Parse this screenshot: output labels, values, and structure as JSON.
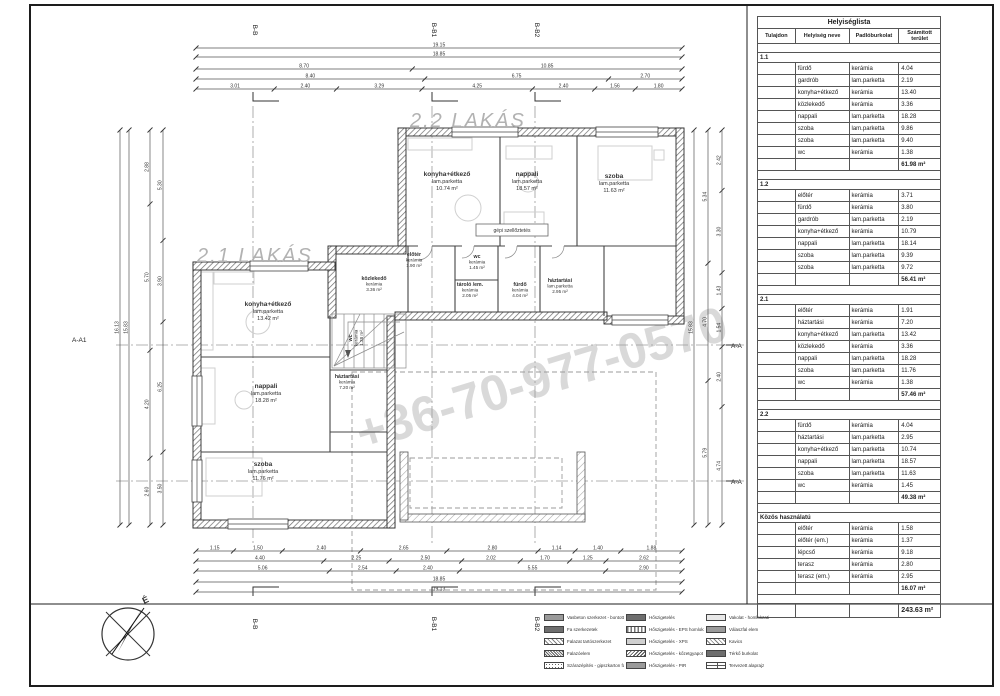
{
  "sheet": {
    "watermark": "+36-70-977-0570"
  },
  "plan": {
    "title_21": "2.1 LAKÁS",
    "title_22": "2.2 LAKÁS",
    "vent_note": "gépi szellőztetés",
    "rooms": [
      {
        "name": "konyha+étkező",
        "floor": "lam.parketta",
        "area": "10.74 m²"
      },
      {
        "name": "nappali",
        "floor": "lam.parketta",
        "area": "18.57 m²"
      },
      {
        "name": "szoba",
        "floor": "lam.parketta",
        "area": "11.63 m²"
      },
      {
        "name": "előtér",
        "floor": "kerámia",
        "area": "1.90 m²"
      },
      {
        "name": "wc",
        "floor": "kerámia",
        "area": "1.45 m²"
      },
      {
        "name": "tároló /em.",
        "floor": "kerámia",
        "area": "2.05 m²"
      },
      {
        "name": "fürdő",
        "floor": "kerámia",
        "area": "4.04 m²"
      },
      {
        "name": "háztartási",
        "floor": "lam.parketta",
        "area": "2.95 m²"
      },
      {
        "name": "közlekedő",
        "floor": "kerámia",
        "area": "3.36 m²"
      },
      {
        "name": "konyha+étkező",
        "floor": "lam.parketta",
        "area": "13.42 m²"
      },
      {
        "name": "nappali",
        "floor": "lam.parketta",
        "area": "18.28 m²"
      },
      {
        "name": "háztartási",
        "floor": "kerámia",
        "area": "7.20 m²"
      },
      {
        "name": "szoba",
        "floor": "lam.parketta",
        "area": "11.76 m²"
      },
      {
        "name": "wc",
        "floor": "kerámia",
        "area": "1.38 m²"
      }
    ]
  },
  "compass": {
    "north_label": "É"
  },
  "markers": {
    "top": [
      "B-B",
      "B-B1",
      "B-B2"
    ],
    "bottom": [
      "B-B",
      "B-B1",
      "B-B2"
    ],
    "left": "A-A1",
    "right": [
      "A-A",
      "A-A"
    ]
  },
  "dims": {
    "top": [
      [
        "19.15"
      ],
      [
        "18.85"
      ],
      [
        "8.70",
        "10.85"
      ],
      [
        "8.40",
        "6.75",
        "2.70"
      ],
      [
        "3.01",
        "2.40",
        "3.29",
        "4.25",
        "2.40",
        "1.56",
        "1.80"
      ]
    ],
    "bottom": [
      [
        "1.15",
        "1.50",
        "2.40",
        "2.65",
        "2.80",
        "1.14",
        "1.40",
        "1.88"
      ],
      [
        "4.40",
        "2.25",
        "2.50",
        "2.02",
        "1.70",
        "1.25",
        "2.62"
      ],
      [
        "5.06",
        "2.54",
        "2.40",
        "5.55",
        "2.90"
      ],
      [
        "18.85"
      ],
      [
        "19.13"
      ]
    ],
    "left": [
      [
        "16.13"
      ],
      [
        "15.83"
      ],
      [
        "2.88",
        "5.70",
        "4.20",
        "2.60"
      ],
      [
        "5.30",
        "3.90",
        "6.25",
        "3.50"
      ]
    ],
    "right": [
      [
        "15.83"
      ],
      [
        "5.34",
        "4.70",
        "5.79"
      ],
      [
        "2.42",
        "3.30",
        "1.43",
        "1.54",
        "2.40",
        "4.74"
      ]
    ]
  },
  "table": {
    "title": "Helyiséglista",
    "columns": [
      "Tulajdon",
      "Helyiség neve",
      "Padlóburkolat",
      "Számított terület"
    ],
    "sections": [
      {
        "id": "1.1",
        "rows": [
          [
            "fürdő",
            "kerámia",
            "4.04"
          ],
          [
            "gardrób",
            "lam.parketta",
            "2.19"
          ],
          [
            "konyha+étkező",
            "kerámia",
            "13.40"
          ],
          [
            "közlekedő",
            "kerámia",
            "3.36"
          ],
          [
            "nappali",
            "lam.parketta",
            "18.28"
          ],
          [
            "szoba",
            "lam.parketta",
            "9.86"
          ],
          [
            "szoba",
            "lam.parketta",
            "9.40"
          ],
          [
            "wc",
            "kerámia",
            "1.38"
          ]
        ],
        "subtotal": "61.98 m²"
      },
      {
        "id": "1.2",
        "rows": [
          [
            "előtér",
            "kerámia",
            "3.71"
          ],
          [
            "fürdő",
            "kerámia",
            "3.80"
          ],
          [
            "gardrób",
            "lam.parketta",
            "2.19"
          ],
          [
            "konyha+étkező",
            "kerámia",
            "10.79"
          ],
          [
            "nappali",
            "lam.parketta",
            "18.14"
          ],
          [
            "szoba",
            "lam.parketta",
            "9.39"
          ],
          [
            "szoba",
            "lam.parketta",
            "9.72"
          ]
        ],
        "subtotal": "56.41 m²"
      },
      {
        "id": "2.1",
        "rows": [
          [
            "előtér",
            "kerámia",
            "1.91"
          ],
          [
            "háztartási",
            "kerámia",
            "7.20"
          ],
          [
            "konyha+étkező",
            "lam.parketta",
            "13.42"
          ],
          [
            "közlekedő",
            "kerámia",
            "3.36"
          ],
          [
            "nappali",
            "lam.parketta",
            "18.28"
          ],
          [
            "szoba",
            "lam.parketta",
            "11.76"
          ],
          [
            "wc",
            "kerámia",
            "1.38"
          ]
        ],
        "subtotal": "57.46 m²"
      },
      {
        "id": "2.2",
        "rows": [
          [
            "fürdő",
            "kerámia",
            "4.04"
          ],
          [
            "háztartási",
            "lam.parketta",
            "2.95"
          ],
          [
            "konyha+étkező",
            "lam.parketta",
            "10.74"
          ],
          [
            "nappali",
            "lam.parketta",
            "18.57"
          ],
          [
            "szoba",
            "lam.parketta",
            "11.63"
          ],
          [
            "wc",
            "kerámia",
            "1.45"
          ]
        ],
        "subtotal": "49.38 m²"
      },
      {
        "id": "Közös használatú",
        "rows": [
          [
            "előtér",
            "kerámia",
            "1.58"
          ],
          [
            "előtér (em.)",
            "kerámia",
            "1.37"
          ],
          [
            "lépcső",
            "kerámia",
            "9.18"
          ],
          [
            "terasz",
            "kerámia",
            "2.80"
          ],
          [
            "terasz (em.)",
            "kerámia",
            "2.95"
          ]
        ],
        "subtotal": "16.07 m²"
      }
    ],
    "total": "243.63 m²"
  },
  "legend": {
    "items": [
      {
        "label": "Vasbeton szerkezet - bontott",
        "swatch": "solid-mid"
      },
      {
        "label": "Hőszigetelés",
        "swatch": "solid-dark"
      },
      {
        "label": "Vakolat - homlokzati",
        "swatch": "solid-light"
      },
      {
        "label": "Fa szerkezetek",
        "swatch": "solid-dark"
      },
      {
        "label": "Hőszigetelés - EPS homlokzati",
        "swatch": "waves"
      },
      {
        "label": "Válaszfal elem",
        "swatch": "solid-mid"
      },
      {
        "label": "Falazat tartószerkezet",
        "swatch": "hatch-light"
      },
      {
        "label": "Hőszigetelés - XPS",
        "swatch": "dots-dense"
      },
      {
        "label": "Kavics",
        "swatch": "hatch-light"
      },
      {
        "label": "Falazóelem",
        "swatch": "hatch-dense"
      },
      {
        "label": "Hőszigetelés - kőzetgyapot",
        "swatch": "zigzag"
      },
      {
        "label": "Térkő burkolat",
        "swatch": "solid-dark"
      },
      {
        "label": "Szárazépítés - gipszkarton fal - bontott",
        "swatch": "dots"
      },
      {
        "label": "Hőszigetelés - PIR",
        "swatch": "solid-mid"
      },
      {
        "label": "Tervezett alaprajz",
        "swatch": "plan"
      }
    ]
  }
}
